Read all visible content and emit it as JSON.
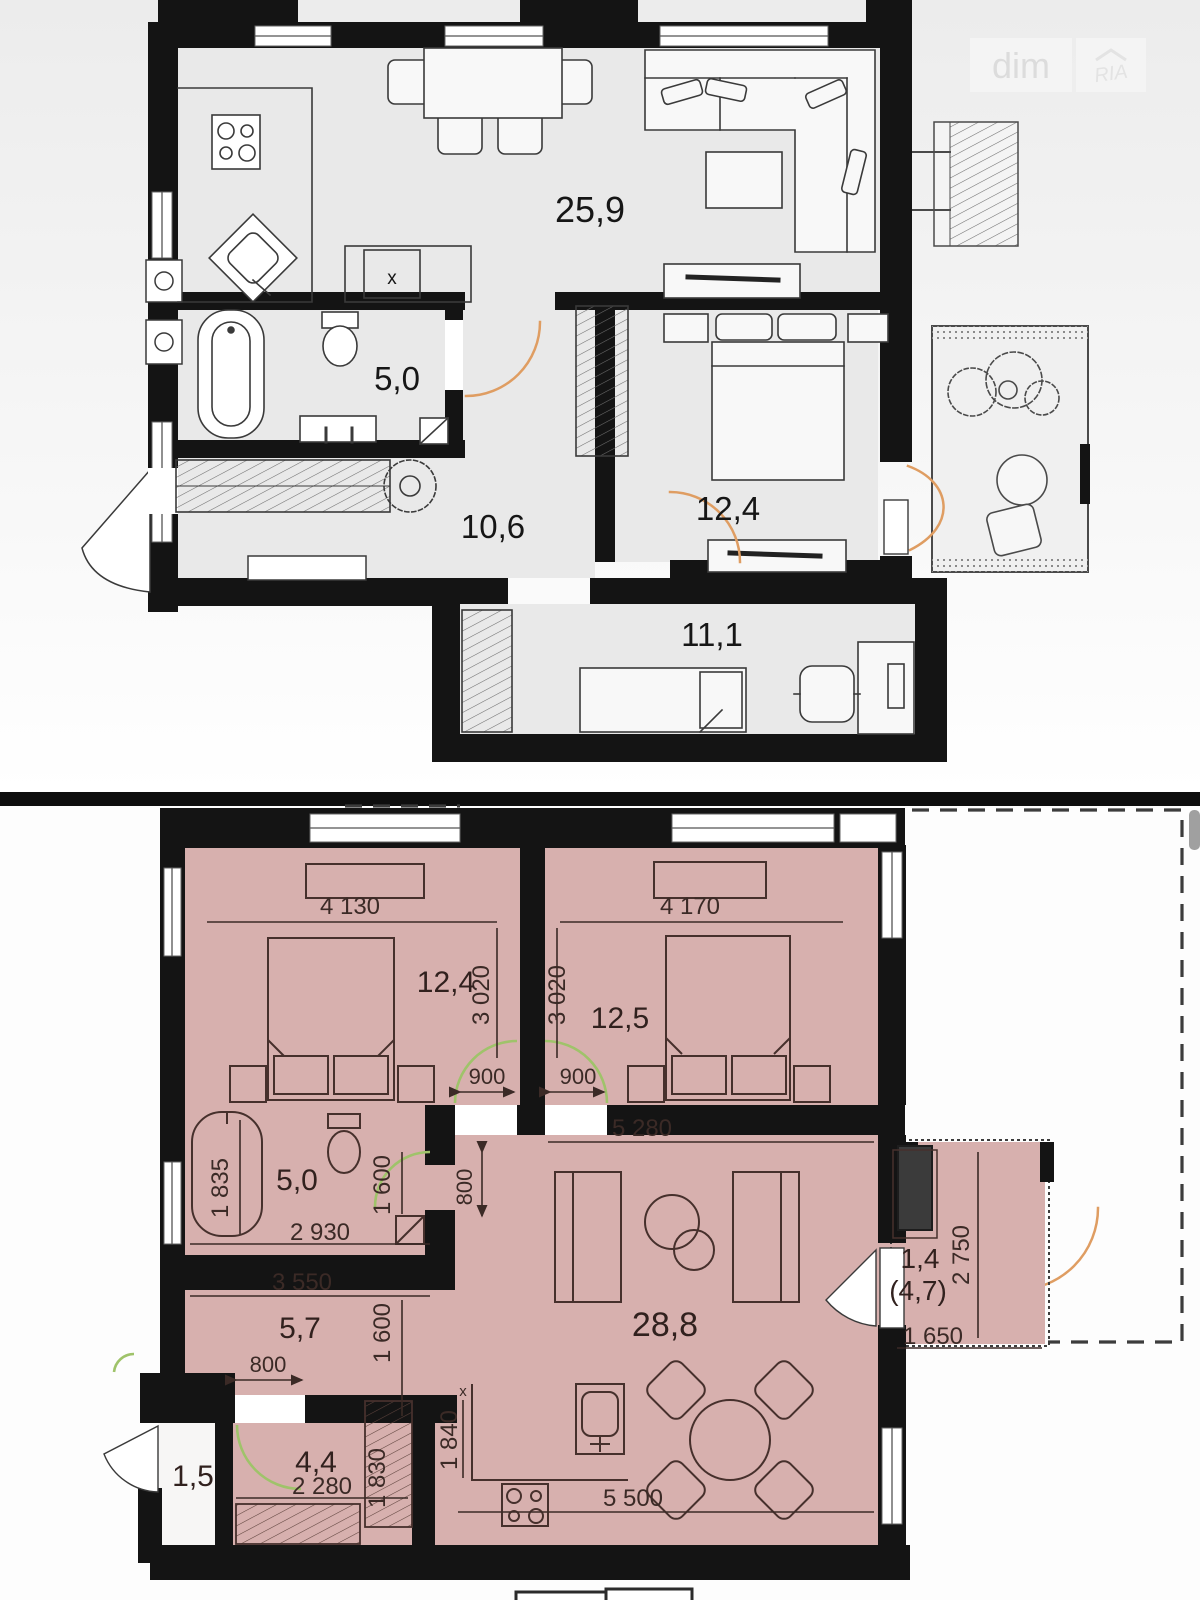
{
  "watermark": {
    "brand": "dim",
    "logo": "RIA"
  },
  "upper_plan": {
    "rooms": {
      "living_kitchen": "25,9",
      "bathroom": "5,0",
      "hallway": "10,6",
      "bedroom": "12,4",
      "kids_room": "11,1"
    },
    "kitchen_cabinet_mark": "x"
  },
  "lower_plan": {
    "rooms": {
      "bedroom_left": "12,4",
      "bedroom_right": "12,5",
      "bathroom": "5,0",
      "hallway": "5,7",
      "living_kitchen": "28,8",
      "balcony": "1,4",
      "balcony_total": "(4,7)",
      "storage": "4,4",
      "entry": "1,5"
    },
    "dims": {
      "bedroom_left_width": "4 130",
      "bedroom_left_depth": "3 020",
      "bedroom_right_width": "4 170",
      "bedroom_right_depth": "3 020",
      "bedroom_left_door": "900",
      "bedroom_right_door": "900",
      "living_top_width": "5 280",
      "bathroom_width": "1 835",
      "bathroom_inner_width": "2 930",
      "bathroom_depth": "1 600",
      "living_door": "800",
      "hallway_width": "3 550",
      "hallway_depth": "1 600",
      "storage_door": "800",
      "storage_width": "2 280",
      "storage_closet_depth": "1 830",
      "kitchen_depth": "1 840",
      "kitchen_width": "5 500",
      "balcony_depth": "2 750",
      "balcony_width": "1 650",
      "tick_mark": "x"
    }
  }
}
